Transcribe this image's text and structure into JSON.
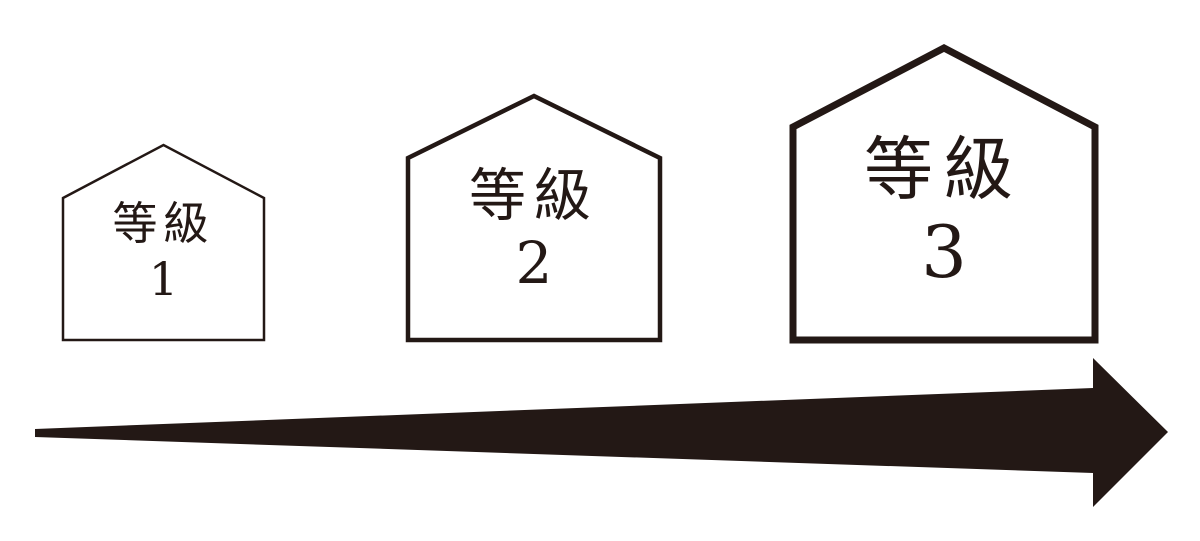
{
  "diagram": {
    "background_color": "#ffffff",
    "ink_color": "#231815",
    "houses": [
      {
        "label": "等級",
        "number": "1"
      },
      {
        "label": "等級",
        "number": "2"
      },
      {
        "label": "等級",
        "number": "3"
      }
    ],
    "arrow": {
      "direction": "right"
    }
  }
}
